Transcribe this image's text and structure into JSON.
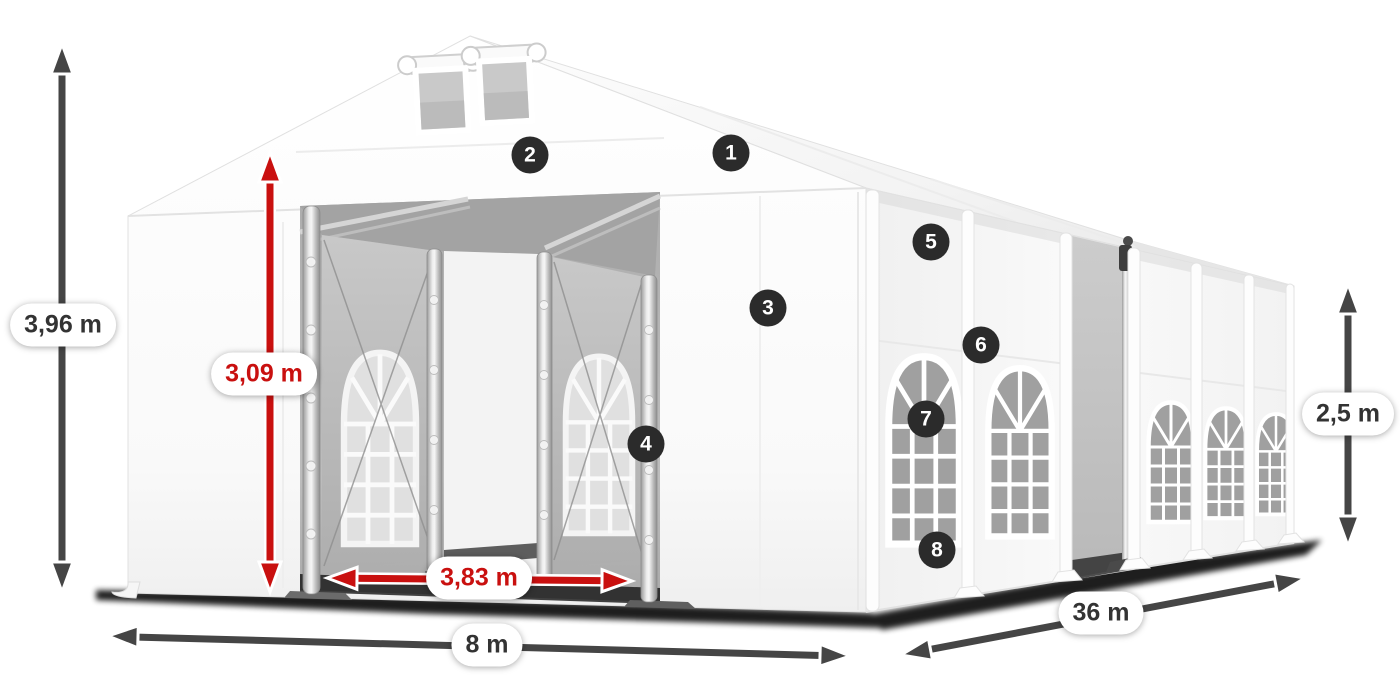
{
  "diagram": {
    "dimension_labels": {
      "total_height": "3,96 m",
      "entrance_height": "3,09 m",
      "entrance_width": "3,83 m",
      "width": "8 m",
      "length": "36 m",
      "side_height": "2,5 m"
    },
    "feature_markers": [
      {
        "number": "1"
      },
      {
        "number": "2"
      },
      {
        "number": "3"
      },
      {
        "number": "4"
      },
      {
        "number": "5"
      },
      {
        "number": "6"
      },
      {
        "number": "7"
      },
      {
        "number": "8"
      }
    ],
    "colors": {
      "highlight_red": "#c9100f",
      "arrow_gray": "#454545",
      "marker_background": "#2b2b2b",
      "label_text": "#333333",
      "background": "#ffffff"
    }
  }
}
